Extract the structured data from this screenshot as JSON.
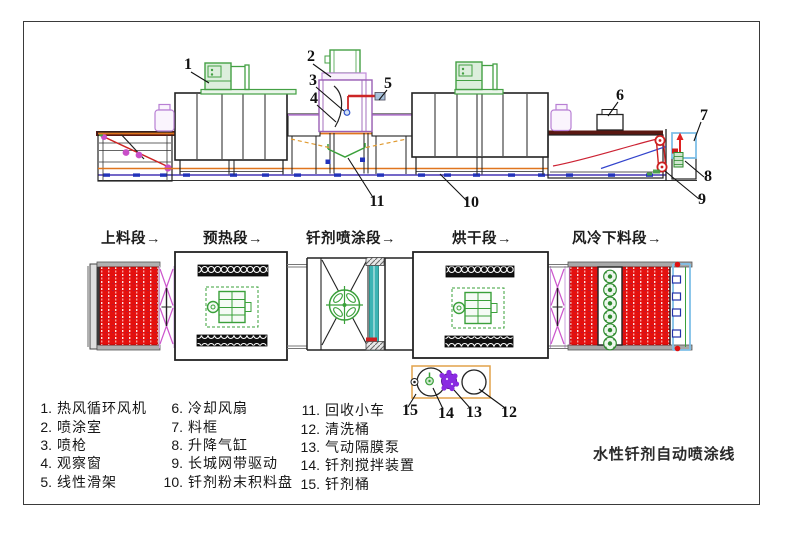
{
  "drawing_title": "水性钎剂自动喷涂线",
  "section_labels": [
    "上料段→",
    "预热段→",
    "钎剂喷涂段→",
    "烘干段→",
    "风冷下料段→"
  ],
  "legend": {
    "col1": [
      {
        "num": "1.",
        "label": "热风循环风机"
      },
      {
        "num": "2.",
        "label": "喷涂室"
      },
      {
        "num": "3.",
        "label": "喷枪"
      },
      {
        "num": "4.",
        "label": "观察窗"
      },
      {
        "num": "5.",
        "label": "线性滑架"
      }
    ],
    "col2": [
      {
        "num": "6.",
        "label": "冷却风扇"
      },
      {
        "num": "7.",
        "label": "料框"
      },
      {
        "num": "8.",
        "label": "升降气缸"
      },
      {
        "num": "9.",
        "label": "长城网带驱动"
      },
      {
        "num": "10.",
        "label": "钎剂粉末积料盘"
      }
    ],
    "col3": [
      {
        "num": "11.",
        "label": "回收小车"
      },
      {
        "num": "12.",
        "label": "清洗桶"
      },
      {
        "num": "13.",
        "label": "气动隔膜泵"
      },
      {
        "num": "14.",
        "label": "钎剂搅拌装置"
      },
      {
        "num": "15.",
        "label": "钎剂桶"
      }
    ]
  },
  "callouts": [
    "1",
    "2",
    "3",
    "4",
    "5",
    "6",
    "7",
    "8",
    "9",
    "10",
    "11",
    "12",
    "13",
    "14",
    "15"
  ],
  "colors": {
    "belt_red": "#e4100e",
    "machine_green": "#44a044",
    "roller_magenta": "#c94fc9",
    "jar_purple": "#b87fd4",
    "conveyor_orange": "#e0751e",
    "rail_brown": "#5a1812",
    "base_blue": "#7468c8",
    "spray_teal": "#3cb4b4",
    "frame_lightblue": "#7fc0e8",
    "pump_purple": "#8a2be2",
    "drive_red": "#cc2020",
    "bucket_box_orange": "#e2a24a"
  }
}
